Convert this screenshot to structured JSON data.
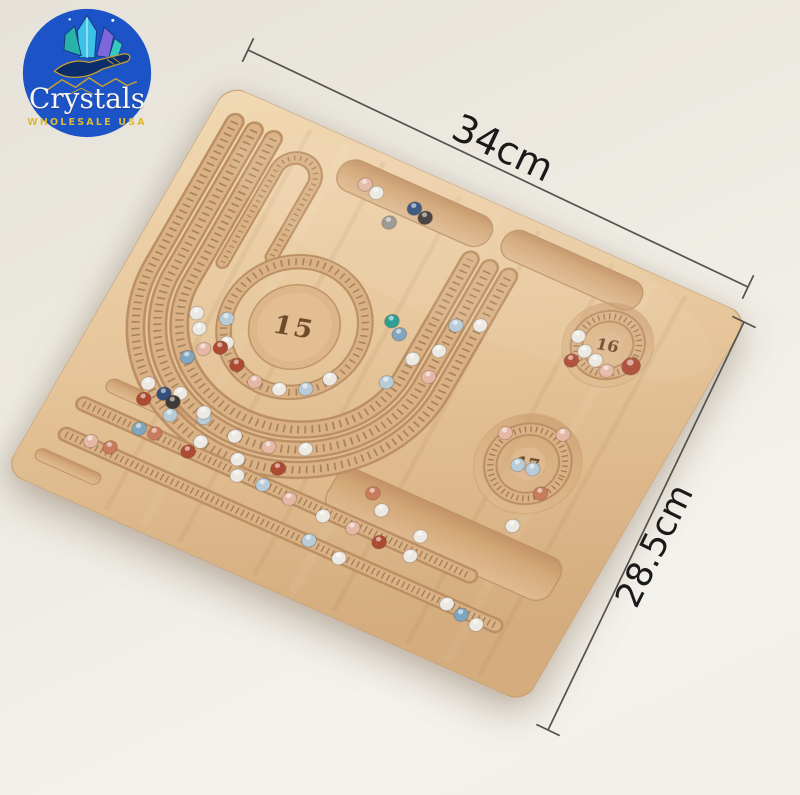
{
  "logo": {
    "brand": "Crystals",
    "tagline": "WHOLESALE USA",
    "circle_color": "#1c53c7",
    "brand_color": "#f7f5f0",
    "tagline_color": "#ddbb2e"
  },
  "dimensions": {
    "width_label": "34cm",
    "height_label": "28.5cm",
    "line_color": "#55514c",
    "label_color": "#1a1a1a"
  },
  "board": {
    "center_circle_label": "15",
    "small_circle_top_label": "16",
    "small_circle_bottom_label": "17",
    "wood_color": "#e7c79c",
    "groove_color": "#dab285",
    "tick_color": "#6d4f2c",
    "engraving_color": "#5d3c1c"
  },
  "beads": [
    {
      "x": 170,
      "y": 36,
      "c": "#e5b8a6"
    },
    {
      "x": 184,
      "y": 39,
      "c": "#ece8e2"
    },
    {
      "x": 225,
      "y": 38,
      "c": "#33507c"
    },
    {
      "x": 239,
      "y": 42,
      "c": "#3e3a36"
    },
    {
      "x": 210,
      "y": 61,
      "c": "#98948f"
    },
    {
      "x": 341,
      "y": 118,
      "c": "#ece8e2"
    },
    {
      "x": 320,
      "y": 128,
      "c": "#b7ccd8"
    },
    {
      "x": 318,
      "y": 158,
      "c": "#ece8e2"
    },
    {
      "x": 322,
      "y": 186,
      "c": "#e5b8a6"
    },
    {
      "x": 299,
      "y": 176,
      "c": "#ece8e2"
    },
    {
      "x": 288,
      "y": 208,
      "c": "#b7ccd8"
    },
    {
      "x": 262,
      "y": 150,
      "c": "#2f9e94"
    },
    {
      "x": 275,
      "y": 159,
      "c": "#7fa6bf"
    },
    {
      "x": 237,
      "y": 228,
      "c": "#ece8e2"
    },
    {
      "x": 221,
      "y": 247,
      "c": "#b7ccd8"
    },
    {
      "x": 198,
      "y": 258,
      "c": "#ece8e2"
    },
    {
      "x": 173,
      "y": 261,
      "c": "#e5b8a6"
    },
    {
      "x": 149,
      "y": 253,
      "c": "#ad4a32"
    },
    {
      "x": 129,
      "y": 237,
      "c": "#ece8e2"
    },
    {
      "x": 117,
      "y": 215,
      "c": "#b7ccd8"
    },
    {
      "x": 98,
      "y": 235,
      "c": "#ece8e2"
    },
    {
      "x": 112,
      "y": 252,
      "c": "#e5b8a6"
    },
    {
      "x": 126,
      "y": 244,
      "c": "#ad4a32"
    },
    {
      "x": 102,
      "y": 266,
      "c": "#7fa6bf"
    },
    {
      "x": 88,
      "y": 222,
      "c": "#ece8e2"
    },
    {
      "x": 251,
      "y": 302,
      "c": "#ece8e2"
    },
    {
      "x": 218,
      "y": 315,
      "c": "#e5b8a6"
    },
    {
      "x": 183,
      "y": 319,
      "c": "#ece8e2"
    },
    {
      "x": 147,
      "y": 315,
      "c": "#b7ccd8"
    },
    {
      "x": 114,
      "y": 302,
      "c": "#ece8e2"
    },
    {
      "x": 237,
      "y": 331,
      "c": "#ad4a32"
    },
    {
      "x": 197,
      "y": 339,
      "c": "#ece8e2"
    },
    {
      "x": 156,
      "y": 338,
      "c": "#ece8e2"
    },
    {
      "x": 116,
      "y": 326,
      "c": "#b7ccd8"
    },
    {
      "x": 81,
      "y": 306,
      "c": "#ece8e2"
    },
    {
      "x": 100,
      "y": 309,
      "c": "#33507c"
    },
    {
      "x": 112,
      "y": 313,
      "c": "#3e3a36"
    },
    {
      "x": 144,
      "y": 310,
      "c": "#ece8e2"
    },
    {
      "x": 96,
      "y": 351,
      "c": "#7fa6bf"
    },
    {
      "x": 112,
      "y": 349,
      "c": "#c97c5d"
    },
    {
      "x": 150,
      "y": 352,
      "c": "#ad4a32"
    },
    {
      "x": 205,
      "y": 354,
      "c": "#ece8e2"
    },
    {
      "x": 232,
      "y": 352,
      "c": "#b7ccd8"
    },
    {
      "x": 262,
      "y": 354,
      "c": "#e5b8a6"
    },
    {
      "x": 300,
      "y": 356,
      "c": "#ece8e2"
    },
    {
      "x": 332,
      "y": 355,
      "c": "#e5b8a6"
    },
    {
      "x": 362,
      "y": 357,
      "c": "#ad4a32"
    },
    {
      "x": 396,
      "y": 357,
      "c": "#ece8e2"
    },
    {
      "x": 60,
      "y": 382,
      "c": "#e5b8a6"
    },
    {
      "x": 80,
      "y": 380,
      "c": "#c97c5d"
    },
    {
      "x": 300,
      "y": 384,
      "c": "#b7ccd8"
    },
    {
      "x": 335,
      "y": 388,
      "c": "#ece8e2"
    },
    {
      "x": 452,
      "y": 386,
      "c": "#ece8e2"
    },
    {
      "x": 470,
      "y": 390,
      "c": "#7fa6bf"
    },
    {
      "x": 488,
      "y": 393,
      "c": "#ece8e2"
    },
    {
      "x": 85,
      "y": 322,
      "c": "#ad4a32"
    },
    {
      "x": 332,
      "y": 315,
      "c": "#c97c5d"
    },
    {
      "x": 348,
      "y": 327,
      "c": "#ece8e2"
    },
    {
      "x": 395,
      "y": 335,
      "c": "#ece8e2"
    },
    {
      "x": 470,
      "y": 288,
      "c": "#ece8e2"
    },
    {
      "x": 432,
      "y": 88,
      "c": "#ece8e2"
    },
    {
      "x": 445,
      "y": 99,
      "c": "#ece8e2"
    },
    {
      "x": 459,
      "y": 103,
      "c": "#ece8e2"
    },
    {
      "x": 474,
      "y": 108,
      "c": "#e5b8a6"
    },
    {
      "x": 493,
      "y": 94,
      "c": "#ad4a32",
      "r": 9
    },
    {
      "x": 438,
      "y": 113,
      "c": "#ad4a32"
    },
    {
      "x": 444,
      "y": 230,
      "c": "#b7ccd8"
    },
    {
      "x": 459,
      "y": 228,
      "c": "#b7ccd8"
    },
    {
      "x": 468,
      "y": 184,
      "c": "#e5b8a6"
    },
    {
      "x": 417,
      "y": 206,
      "c": "#e5b8a6"
    },
    {
      "x": 478,
      "y": 247,
      "c": "#c97c5d"
    }
  ]
}
